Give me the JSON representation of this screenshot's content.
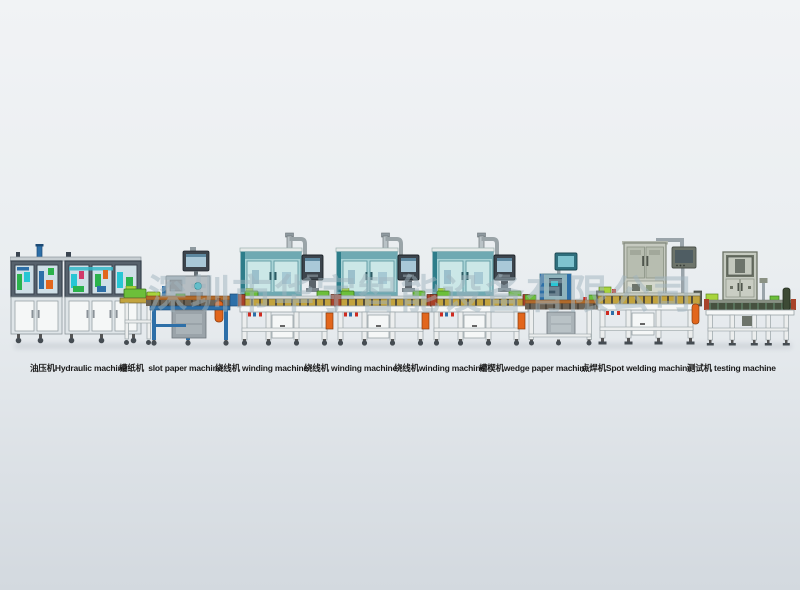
{
  "watermark": {
    "text": "深圳市华宇智能设备有限公司"
  },
  "machines": [
    {
      "zh": "油压机",
      "en": "Hydraulic machine",
      "caption": "油压机Hydraulic machine"
    },
    {
      "zh": "槽纸机",
      "en": "slot paper machine",
      "caption": "槽纸机  slot paper machine"
    },
    {
      "zh": "绕线机",
      "en": "winding machine",
      "caption": "绕线机 winding machine"
    },
    {
      "zh": "绕线机",
      "en": "winding machine",
      "caption": "绕线机 winding machine"
    },
    {
      "zh": "绕线机",
      "en": "winding machine",
      "caption": "绕线机winding machine"
    },
    {
      "zh": "槽楔机",
      "en": "wedge paper machine",
      "caption": "槽楔机wedge paper machine"
    },
    {
      "zh": "点焊机",
      "en": "Spot welding machine",
      "caption": "点焊机Spot welding machine"
    },
    {
      "zh": "测试机",
      "en": "testing machine",
      "caption": "测试机 testing machine"
    }
  ],
  "colors": {
    "bg-top": "#f1f3f5",
    "bg-mid": "#e9edf0",
    "bg-bottom": "#d3d9df",
    "frame-blue": "#2d6fa8",
    "frame-dark": "#57626d",
    "panel-white": "#f5f7f7",
    "panel-gray": "#dfe5e8",
    "glass-pane": "#cfdfe7",
    "glass-teal": "#a8d3d6",
    "glass-teal-light": "#cbe7e7",
    "teal-frame": "#5f9aa3",
    "teal-band": "#6fa9b2",
    "conveyor-yellow": "#c2a33e",
    "conveyor-dark": "#564f3b",
    "rail-brown": "#b06a2a",
    "item-green": "#6cbf3a",
    "item-lime": "#a8d43c",
    "accent-orange": "#e2661c",
    "accent-red": "#cf2b20",
    "cabinet-olive": "#c6cac0",
    "door-olive": "#b7bdb0",
    "olive-frame": "#7f867a",
    "monitor-dark": "#3c444c",
    "screen-blue": "#a9c8d8",
    "steel": "#9aa4aa",
    "leg-white": "#eceeee",
    "leg-stroke": "#98a2a6",
    "wheel-dark": "#454c52",
    "end-red": "#a8432a",
    "caption-color": "#1b1b1b",
    "watermark-color": "rgba(160,180,190,0.5)",
    "shadow": "rgba(120,130,142,0.18)"
  }
}
